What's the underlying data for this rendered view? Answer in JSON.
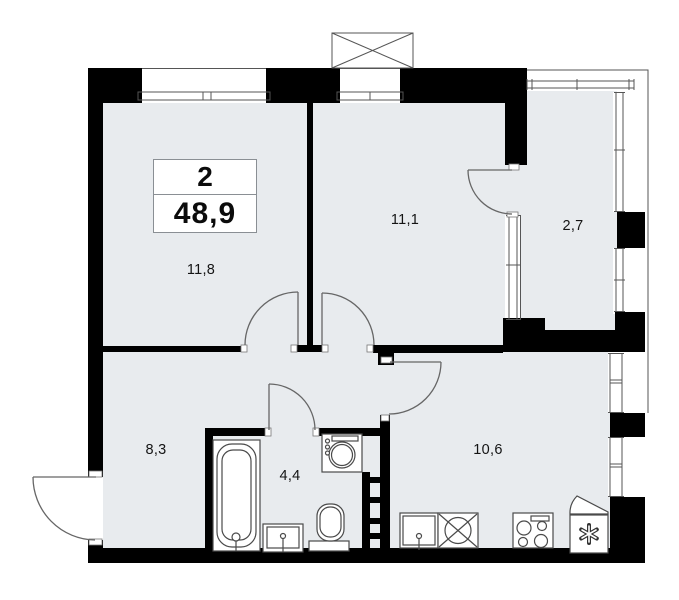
{
  "plan": {
    "title_box": {
      "rooms_count": "2",
      "total_area": "48,9"
    },
    "rooms": [
      {
        "id": "living-room",
        "area": "11,8"
      },
      {
        "id": "bedroom",
        "area": "11,1"
      },
      {
        "id": "balcony",
        "area": "2,7"
      },
      {
        "id": "hallway",
        "area": "8,3"
      },
      {
        "id": "bathroom",
        "area": "4,4"
      },
      {
        "id": "kitchen",
        "area": "10,6"
      }
    ],
    "fixtures": [
      "bathtub",
      "vanity-sink",
      "toilet",
      "washing-machine",
      "duct-ladder",
      "kitchen-counter",
      "kitchen-sink",
      "stove",
      "fridge",
      "ventilation-box"
    ],
    "icons": {
      "ventilation": "crossed-box-icon",
      "fridge": "snowflake-icon"
    },
    "colors": {
      "wall": "#000000",
      "floor": "#e8ebee",
      "line": "#555555",
      "fixture_line": "#4a4a4a",
      "background": "#ffffff",
      "text": "#141414"
    }
  }
}
